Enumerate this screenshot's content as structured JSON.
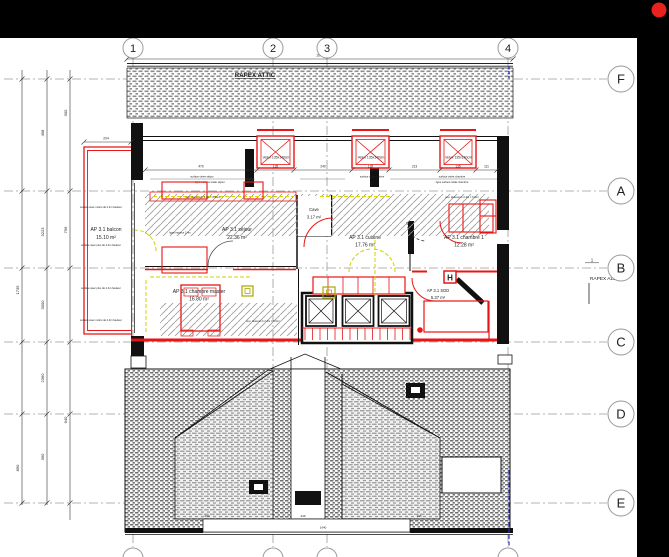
{
  "frame": {
    "dot_color": "#e8221c"
  },
  "grid": {
    "cols": [
      "1",
      "2",
      "3",
      "4"
    ],
    "rows": [
      "F",
      "A",
      "B",
      "C",
      "D",
      "E"
    ]
  },
  "titles": {
    "attic_band": "RAPEX ATTIC",
    "section_ref_num": "1",
    "section_ref": "RAPEX A116"
  },
  "rooms": {
    "balcon": {
      "name": "AP 3.1 balcon",
      "area": "15.10 m²"
    },
    "sejour": {
      "name": "AP 3.1 séjour",
      "area": "22.36 m²"
    },
    "cave": {
      "name": "Cave",
      "area": "3.17 m²"
    },
    "cuisine": {
      "name": "AP 3.1 cuisine",
      "area": "17.76 m²"
    },
    "chambre1": {
      "name": "AP 3.1 chambre 1",
      "area": "12.28 m²"
    },
    "master": {
      "name": "AP 3.1 chambre master",
      "area": "16.80 m²"
    },
    "sdd": {
      "name": "AP 3.1 SDD",
      "area": "5.37 m²"
    }
  },
  "windows": {
    "velux": "Velux 135x140cm"
  },
  "symbols": {
    "hydrant": "H"
  },
  "annotations": {
    "surface_vitree_sejour": "surface vitrée séjour",
    "ligne_surface_sejour": "ligne surface totale séjour",
    "surface_vitree_cuisine": "surface vitrée cuisine",
    "surface_vitree_chambre": "surface vitrée chambre",
    "ligne_surface_chambre": "ligne surface totale chambre",
    "sup_dessous_sejour": "sup. dessous h 2.4m = 6.96m²",
    "sup_dessous_chambre": "sup. dessous h 2.4m = 6.3m²",
    "sup_dessous_master": "sup. dessous h 2.4m = 6.3m²",
    "ligne_hauteur": "ligne hauteur 2.4m",
    "haut_moins_1": "surface avec moins de 2.4m hauteur",
    "haut_plus_1": "surface avec plus de 2.4m hauteur",
    "haut_plus_2": "surface avec plus de 2.4m hauteur",
    "haut_moins_2": "surface avec moins de 2.4m hauteur"
  },
  "dimensions": {
    "top_total": "1602",
    "balcon": "204",
    "win": [
      "470",
      "135",
      "240",
      "135",
      "213",
      "135",
      "111"
    ],
    "left": [
      "1735",
      "890",
      "498",
      "3223",
      "3000",
      "2360",
      "390",
      "300",
      "756",
      "640"
    ],
    "bottom": [
      "204",
      "246",
      "145",
      "1640"
    ]
  }
}
